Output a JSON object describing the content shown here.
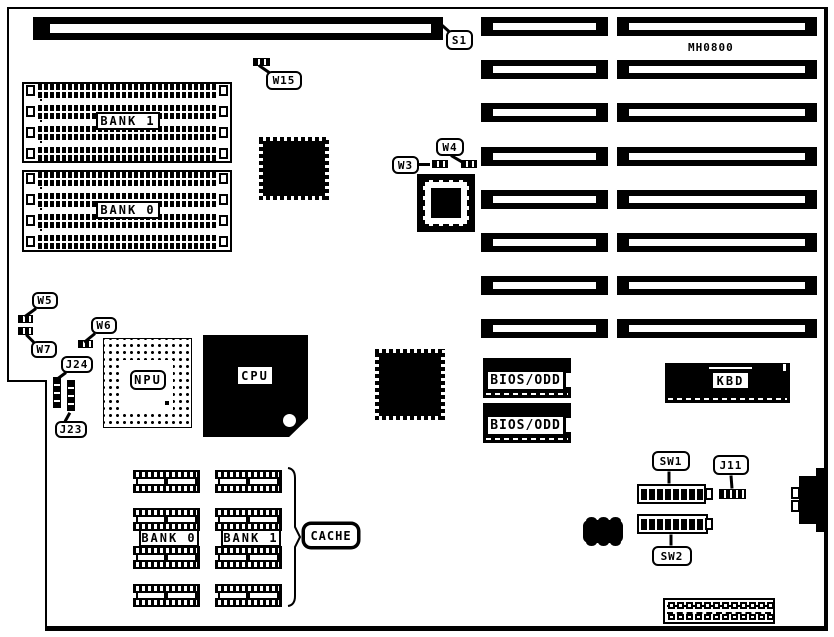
{
  "board": {
    "model_label": "MH0800"
  },
  "slots": {
    "s1_label": "S1",
    "left_count": 8,
    "right_count": 8
  },
  "memory": {
    "bank1_label": "BANK 1",
    "bank0_label": "BANK 0",
    "rows_per_bank": 4
  },
  "cache": {
    "label": "CACHE",
    "bank0_label": "BANK 0",
    "bank1_label": "BANK 1",
    "rows": 4
  },
  "chips": {
    "npu_label": "NPU",
    "cpu_label": "CPU",
    "kbd_label": "KBD",
    "bios_top_label": "BIOS/ODD",
    "bios_bottom_label": "BIOS/ODD"
  },
  "jumpers": {
    "w15": "W15",
    "w3": "W3",
    "w4": "W4",
    "w5": "W5",
    "w6": "W6",
    "w7": "W7",
    "j24": "J24",
    "j23": "J23",
    "j11": "J11"
  },
  "switches": {
    "sw1": "SW1",
    "sw2": "SW2",
    "positions": 8
  },
  "connectors": {
    "power_pin_count": 12
  }
}
